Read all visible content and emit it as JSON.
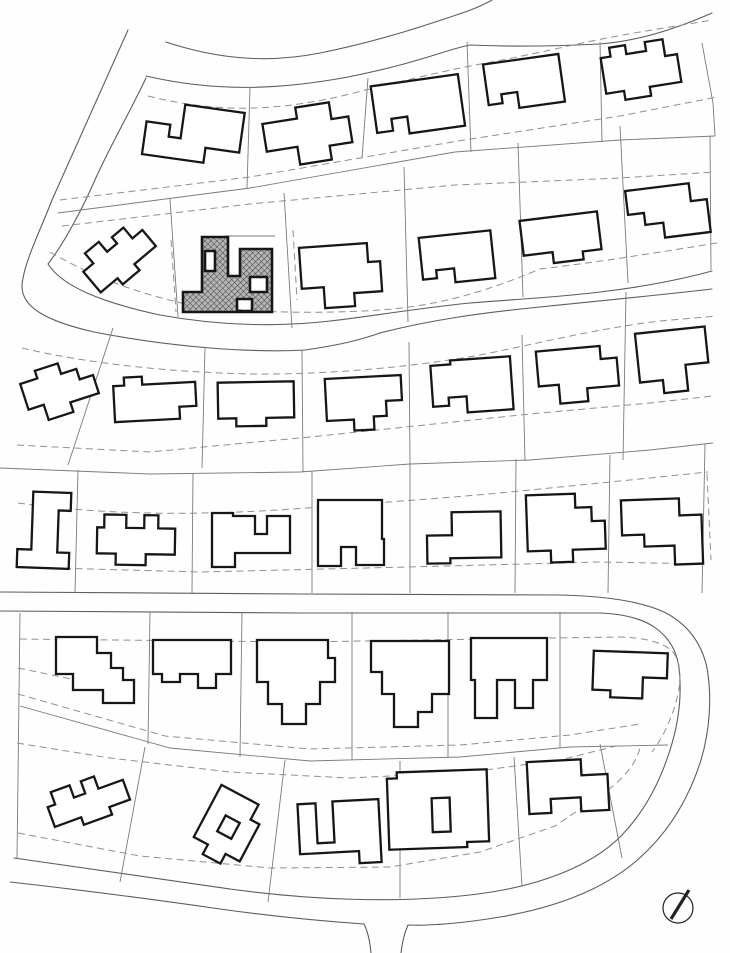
{
  "meta": {
    "drawing_type": "residential site plan",
    "description": "black and white subdivision plot plan with house footprints, lot lines, dashed setback lines, curving streets, one highlighted hatched house and a north arrow",
    "visible_text": ""
  },
  "canvas": {
    "width": 730,
    "height": 953,
    "background": "#fefefe"
  },
  "colors": {
    "road": "#5d5d5d",
    "lot_line": "#7a7a7a",
    "setback": "#8f8f8f",
    "house_stroke": "#161616",
    "house_fill": "#ffffff",
    "hatch_bg": "#b5b5b5",
    "hatch_line": "#3f3f3f",
    "north_arrow": "#222222"
  },
  "stroke_widths": {
    "road": 1.1,
    "lot_line": 0.9,
    "setback": 1.0,
    "house": 2.3,
    "highlight_house": 2.6,
    "needle": 3.2
  },
  "dash_pattern": "7 4.5",
  "map": {
    "roads": [
      {
        "name": "top-street-upper-edge",
        "d": "M166,42 C220,60 270,63 320,53 C380,41 430,24 468,11 C476,8 485,4 492,0"
      },
      {
        "name": "top-street-lower-edge",
        "d": "M146,76 C215,92 278,90 348,77 C415,64 448,49 470,45 C515,47 560,46 600,44 C640,41 678,28 712,13"
      },
      {
        "name": "west-street-outer-mid-street-lower",
        "d": "M128,30 L52,200 C41,229 24,262 22,285 C21,307 46,321 94,332 C170,347 250,353 305,350 C340,345 360,340 380,333 C430,320 480,313 540,307 C600,301 660,295 712,289"
      },
      {
        "name": "west-street-inner-mid-street-upper",
        "d": "M146,78 C128,116 110,146 94,182 C80,214 62,246 48,264 C62,286 100,302 160,315 C220,326 280,327 330,321 C380,315 420,308 470,303 C520,299 560,297 600,292 C650,286 690,277 712,271"
      },
      {
        "name": "lower-street-upper-edge-and-outer-ring",
        "d": "M0,592 L300,594 L560,595 C605,596 640,601 664,612 C688,624 702,644 707,668 C712,696 710,730 701,760 C690,795 672,826 648,850 C615,884 565,906 500,917 C465,923 430,926 408,925 C404,934 402,944 401,953"
      },
      {
        "name": "bottom-street-outer-west-of-junction",
        "d": "M371,953 C370,942 368,932 364,924 C320,921 270,916 220,909 C150,899 64,888 10,882"
      },
      {
        "name": "lower-street-lower-edge-and-inner-ring",
        "d": "M0,611 L300,613 L600,613 C625,614 644,619 657,629 C670,639 677,652 679,668 C682,694 679,722 670,750 C660,782 644,812 622,835 C592,866 540,886 478,894 C400,904 310,900 230,889 C150,878 70,866 14,858"
      }
    ],
    "lot_lines": [
      {
        "name": "row1-rear-lot-line",
        "d": "M58,213 L250,188 L455,152 L620,140 L715,136"
      },
      {
        "name": "row1-side",
        "d": "M250,87 L247,188"
      },
      {
        "name": "row1-side",
        "d": "M368,78 L362,158"
      },
      {
        "name": "row1-side",
        "d": "M467,42 L471,152"
      },
      {
        "name": "row1-side",
        "d": "M600,42 L602,142"
      },
      {
        "name": "row1-side",
        "d": "M702,43 L713,103 L715,136"
      },
      {
        "name": "row2-side",
        "d": "M170,199 L178,317"
      },
      {
        "name": "row2-side",
        "d": "M284,193 L292,328"
      },
      {
        "name": "row2-side",
        "d": "M404,167 L408,322"
      },
      {
        "name": "row2-side",
        "d": "M518,143 L523,297"
      },
      {
        "name": "row2-side",
        "d": "M620,126 L628,283"
      },
      {
        "name": "row2-side",
        "d": "M710,136 L711,270"
      },
      {
        "name": "row3-row4-rear-lot-line",
        "d": "M0,468 L150,474 L300,472 L410,464 L530,460 L650,450 L713,443"
      },
      {
        "name": "row3-side",
        "d": "M113,328 L68,465"
      },
      {
        "name": "row3-side",
        "d": "M205,348 L202,468"
      },
      {
        "name": "row3-side",
        "d": "M302,350 L303,472"
      },
      {
        "name": "row3-side",
        "d": "M409,342 L410,464"
      },
      {
        "name": "row3-side",
        "d": "M522,335 L525,461"
      },
      {
        "name": "row3-side",
        "d": "M626,292 L623,460"
      },
      {
        "name": "row4-side",
        "d": "M78,470 L75,593"
      },
      {
        "name": "row4-side",
        "d": "M193,473 L192,593"
      },
      {
        "name": "row4-side",
        "d": "M312,471 L312,593"
      },
      {
        "name": "row4-side",
        "d": "M410,464 L410,593"
      },
      {
        "name": "row4-side",
        "d": "M516,459 L515,593"
      },
      {
        "name": "row4-side",
        "d": "M610,455 L608,593"
      },
      {
        "name": "row4-side",
        "d": "M705,444 L702,593"
      },
      {
        "name": "row5-row6-rear-lot-line",
        "d": "M20,706 L170,748 L310,761 L460,757 L570,747 L668,745"
      },
      {
        "name": "west-block-edge",
        "d": "M20,613 L17,858"
      },
      {
        "name": "row5-side",
        "d": "M150,612 L148,744"
      },
      {
        "name": "row5-side",
        "d": "M242,612 L240,757"
      },
      {
        "name": "row5-side",
        "d": "M352,612 L352,760"
      },
      {
        "name": "row5-side",
        "d": "M448,612 L448,757"
      },
      {
        "name": "row5-side",
        "d": "M560,612 L560,748"
      },
      {
        "name": "row6-side",
        "d": "M145,747 L120,882"
      },
      {
        "name": "row6-side",
        "d": "M285,760 L268,902"
      },
      {
        "name": "row6-side",
        "d": "M400,761 L400,898"
      },
      {
        "name": "row6-side",
        "d": "M514,757 L522,886"
      },
      {
        "name": "row6-side",
        "d": "M600,744 L622,858"
      },
      {
        "name": "highlight-terrace-wall",
        "d": "M225,236 L275,236"
      }
    ],
    "setbacks": [
      {
        "d": "M148,96 C220,114 280,111 350,94 C410,79 440,72 470,66 C520,57 550,50 587,42 C630,33 672,27 712,20"
      },
      {
        "d": "M60,200 L250,177 L458,141 L620,116 L717,97"
      },
      {
        "d": "M62,226 L250,204 L455,185 L620,178 L715,172"
      },
      {
        "d": "M50,252 C95,278 140,294 190,305 C255,313 320,314 380,310 C440,306 490,290 540,269 C600,262 660,252 717,243"
      },
      {
        "d": "M22,348 C90,364 170,372 250,374 C330,375 420,366 480,355 C540,343 600,328 660,321 L717,316"
      },
      {
        "d": "M17,445 L150,452 L310,437 L530,414 L650,403 L713,396"
      },
      {
        "d": "M18,503 C120,517 220,515 320,507 C400,501 450,498 530,490 C600,483 660,477 708,472"
      },
      {
        "d": "M18,567 L200,572 L407,567 L600,562 L705,564"
      },
      {
        "d": "M707,474 L711,560"
      },
      {
        "d": "M20,639 L300,642 L550,638 L620,637 C650,638 668,644 675,655 C681,665 681,680 678,694 C673,716 664,736 652,752"
      },
      {
        "d": "M18,668 L115,688"
      },
      {
        "d": "M18,694 L165,736 L310,749 L460,745 L570,735 L640,724"
      },
      {
        "d": "M17,743 L110,758 L230,772 L350,778 L470,772 L560,760 L620,745"
      },
      {
        "d": "M18,833 L140,856 L270,868 L390,867 L480,852 L555,826 L608,790 C625,777 636,763 640,748"
      },
      {
        "d": "M171,240 L176,312"
      },
      {
        "d": "M293,230 L297,300"
      }
    ],
    "houses": [
      {
        "id": "r1h1",
        "cx": 193,
        "cy": 136,
        "angle": 8,
        "d": "M-48,-8 L-24,-8 L-24,4 L-12,4 L-12,-30 L48,-30 L48,10 L14,10 L14,25 L-48,25 Z"
      },
      {
        "id": "r1h2",
        "cx": 308,
        "cy": 137,
        "angle": -9,
        "d": "M-43,-20 L-8,-20 L-8,-31 L26,-31 L26,-14 L43,-14 L43,12 L20,12 L20,26 L-12,26 L-12,8 L-43,8 Z"
      },
      {
        "id": "r1h3",
        "cx": 418,
        "cy": 107,
        "angle": -8,
        "d": "M-44,-27 L44,-27 L44,25 L-12,25 L-12,8 L-28,8 L-28,20 L-44,20 Z"
      },
      {
        "id": "r1h4",
        "cx": 524,
        "cy": 83,
        "angle": -8,
        "d": "M-38,-24 L38,-24 L38,24 L-8,24 L-8,8 L-24,8 L-24,17 L-38,17 Z"
      },
      {
        "id": "r1h5",
        "cx": 641,
        "cy": 70,
        "angle": -9,
        "d": "M-38,-18 L-28,-18 L-28,-27 L-12,-27 L-12,-18 L8,-18 L8,-27 L26,-27 L26,-10 L38,-10 L38,18 L6,18 L6,27 L-20,27 L-20,18 L-38,18 Z"
      },
      {
        "id": "r2h1",
        "cx": 118,
        "cy": 257,
        "angle": -40,
        "d": "M-36,-11 L-23,-11 L-23,-24 L-5,-24 L-5,-11 L8,-11 L8,-19 L23,-19 L23,-5 L36,-5 L36,16 L8,16 L8,24 L-14,24 L-14,16 L-36,16 Z"
      },
      {
        "id": "r2h3",
        "cx": 341,
        "cy": 276,
        "angle": -4,
        "d": "M-40,-31 L28,-31 L28,-12 L40,-12 L40,18 L12,18 L12,31 L-18,31 L-18,10 L-40,10 Z"
      },
      {
        "id": "r2h4",
        "cx": 457,
        "cy": 258,
        "angle": -6,
        "d": "M-36,-24 L36,-24 L36,24 L-4,24 L-4,10 L-22,10 L-22,18 L-36,18 Z"
      },
      {
        "id": "r2h5",
        "cx": 561,
        "cy": 239,
        "angle": -7,
        "d": "M-39,-23 L39,-23 L39,15 L20,15 L20,23 L-10,23 L-10,12 L-39,12 Z"
      },
      {
        "id": "r2h6",
        "cx": 668,
        "cy": 212,
        "angle": -7,
        "d": "M-40,-26 L24,-26 L24,-8 L40,-8 L40,25 L-6,25 L-6,10 L-24,10 L-24,-2 L-40,-2 Z"
      },
      {
        "id": "r3h1",
        "cx": 60,
        "cy": 390,
        "angle": -18,
        "d": "M-36,-18 L-18,-18 L-18,-26 L6,-26 L6,-15 L22,-15 L22,-4 L36,-4 L36,15 L6,15 L6,25 L-20,25 L-20,9 L-36,9 Z"
      },
      {
        "id": "r3h2",
        "cx": 155,
        "cy": 400,
        "angle": -3,
        "d": "M-41,-16 L-30,-16 L-30,-24 L-12,-24 L-12,-16 L41,-16 L41,8 L24,8 L24,20 L-41,20 Z"
      },
      {
        "id": "r3h3",
        "cx": 256,
        "cy": 404,
        "angle": -1,
        "d": "M-38,-22 L38,-22 L38,14 L10,14 L10,22 L-20,22 L-20,14 L-38,14 Z"
      },
      {
        "id": "r3h4",
        "cx": 364,
        "cy": 402,
        "angle": -3,
        "d": "M-38,-25 L38,-25 L38,0 L22,0 L22,15 L9,15 L9,28 L-11,28 L-11,17 L-38,17 Z"
      },
      {
        "id": "r3h5",
        "cx": 472,
        "cy": 388,
        "angle": -4,
        "d": "M-40,-25 L-20,-25 L-20,-29 L40,-29 L40,24 L-6,24 L-6,8 L-24,8 L-24,16 L-40,16 Z"
      },
      {
        "id": "r3h6",
        "cx": 578,
        "cy": 375,
        "angle": -5,
        "d": "M-40,-27 L24,-27 L24,-14 L40,-14 L40,14 L8,14 L8,27 L-20,27 L-20,8 L-40,8 Z"
      },
      {
        "id": "r3h7",
        "cx": 673,
        "cy": 361,
        "angle": -6,
        "d": "M-35,-31 L35,-31 L35,5 L12,5 L12,31 L-12,31 L-12,18 L-35,18 Z"
      },
      {
        "id": "r4h1",
        "cx": 44,
        "cy": 530,
        "angle": 2,
        "d": "M-12,-38 L26,-38 L26,-20 L14,-20 L14,22 L26,22 L26,38 L-26,38 L-26,20 L-12,20 Z"
      },
      {
        "id": "r4h2",
        "cx": 136,
        "cy": 540,
        "angle": 1,
        "d": "M-39,-12 L-32,-12 L-32,-25 L-10,-25 L-10,-12 L8,-12 L8,-25 L22,-25 L22,-12 L39,-12 L39,14 L10,14 L10,25 L-20,25 L-20,14 L-39,14 Z"
      },
      {
        "id": "r4h3",
        "cx": 251,
        "cy": 540,
        "angle": 0,
        "d": "M-39,-27 L-18,-27 L-18,-24 L4,-24 L4,-6 L16,-6 L16,-24 L39,-24 L39,13 L-16,13 L-16,27 L-39,27 Z"
      },
      {
        "id": "r4h4",
        "cx": 351,
        "cy": 533,
        "angle": 0,
        "d": "M-33,-33 L31,-33 L31,6 L33,6 L33,32 L5,32 L5,14 L-10,14 L-10,33 L-33,33 Z"
      },
      {
        "id": "r4h5",
        "cx": 464,
        "cy": 538,
        "angle": -1,
        "d": "M-37,-3 L-12,-3 L-12,-26 L37,-26 L37,20 L-14,20 L-14,25 L-37,25 Z"
      },
      {
        "id": "r4h6",
        "cx": 566,
        "cy": 528,
        "angle": -2,
        "d": "M-39,-34 L10,-34 L10,-20 L26,-20 L26,-6 L39,-6 L39,22 L6,22 L6,34 L-16,34 L-16,22 L-39,22 Z"
      },
      {
        "id": "r4h7",
        "cx": 662,
        "cy": 532,
        "angle": -2,
        "d": "M-40,-33 L18,-33 L18,-16 L40,-16 L40,33 L12,33 L12,14 L-18,14 L-18,2 L-40,2 Z"
      },
      {
        "id": "r5h1",
        "cx": 95,
        "cy": 670,
        "angle": 0,
        "d": "M-39,-33 L2,-33 L2,-17 L16,-17 L16,-2 L28,-2 L28,10 L39,10 L39,33 L8,33 L8,20 L-22,20 L-22,4 L-39,4 Z"
      },
      {
        "id": "r5h2",
        "cx": 192,
        "cy": 664,
        "angle": 0,
        "d": "M-39,-24 L39,-24 L39,10 L24,10 L24,24 L6,24 L6,10 L-12,10 L-12,18 L-30,18 L-30,10 L-39,10 Z"
      },
      {
        "id": "r5h3",
        "cx": 296,
        "cy": 682,
        "angle": 0,
        "d": "M-39,-42 L32,-42 L32,-24 L39,-24 L39,0 L24,0 L24,22 L10,22 L10,42 L-14,42 L-14,22 L-28,22 L-28,0 L-39,0 Z"
      },
      {
        "id": "r5h4",
        "cx": 410,
        "cy": 684,
        "angle": 0,
        "d": "M-39,-43 L39,-43 L39,10 L22,10 L22,28 L8,28 L8,43 L-16,43 L-16,10 L-28,10 L-28,-12 L-39,-12 Z"
      },
      {
        "id": "r5h5",
        "cx": 509,
        "cy": 678,
        "angle": 0,
        "d": "M-38,-40 L38,-40 L38,2 L24,2 L24,30 L6,30 L6,2 L-12,2 L-12,40 L-34,40 L-34,2 L-38,2 Z"
      },
      {
        "id": "r5h6",
        "cx": 630,
        "cy": 675,
        "angle": 2,
        "d": "M-37,-23 L37,-23 L37,2 L13,2 L13,23 L-19,23 L-19,16 L-37,16 Z"
      },
      {
        "id": "r6h1",
        "cx": 88,
        "cy": 801,
        "angle": -20,
        "d": "M-40,-8 L-32,-8 L-32,-21 L-12,-21 L-12,-8 L0,-8 L0,-21 L14,-21 L14,-8 L40,-8 L40,13 L18,13 L18,21 L-12,21 L-12,13 L-40,13 Z"
      },
      {
        "id": "r6h2",
        "cx": 228,
        "cy": 828,
        "angle": 28,
        "d": "M-26,-35 L16,-35 L16,-18 L26,-18 L26,24 L10,24 L10,35 L-10,35 L-10,24 L-26,24 Z M-8,-10 L8,-10 L8,8 L-8,8 Z"
      },
      {
        "id": "r6h3",
        "cx": 342,
        "cy": 832,
        "angle": -3,
        "d": "M-43,-30 L-25,-30 L-25,10 L-8,10 L-8,-31 L38,-31 L38,32 L16,32 L16,20 L-43,20 Z"
      },
      {
        "id": "r6h4",
        "cx": 438,
        "cy": 810,
        "angle": -2,
        "d": "M-50,-33 L-40,-33 L-40,-39 L50,-39 L50,33 L28,33 L28,38 L-50,38 Z M-6,-12 L12,-12 L12,22 L-6,22 Z"
      },
      {
        "id": "r6h5",
        "cx": 568,
        "cy": 786,
        "angle": -3,
        "d": "M-40,-26 L14,-26 L14,-10 L40,-10 L40,26 L12,26 L12,12 L-18,12 L-18,26 L-40,26 Z"
      }
    ],
    "highlighted_house": {
      "id": "r2h2-highlighted",
      "outer": "M202,237 L228,237 L228,276 L240,276 L240,249 L272,249 L272,312 L183,312 L183,292 L202,292 Z",
      "holes": [
        "M205,251 L215,251 L215,271 L205,271 Z",
        "M250,277 L267,277 L267,292 L250,292 Z",
        "M237,299 L252,299 L252,311 L237,311 Z"
      ]
    },
    "north_arrow": {
      "cx": 678,
      "cy": 908,
      "radius": 15,
      "needle": {
        "x1": 671,
        "y1": 919,
        "x2": 689,
        "y2": 890
      }
    }
  }
}
